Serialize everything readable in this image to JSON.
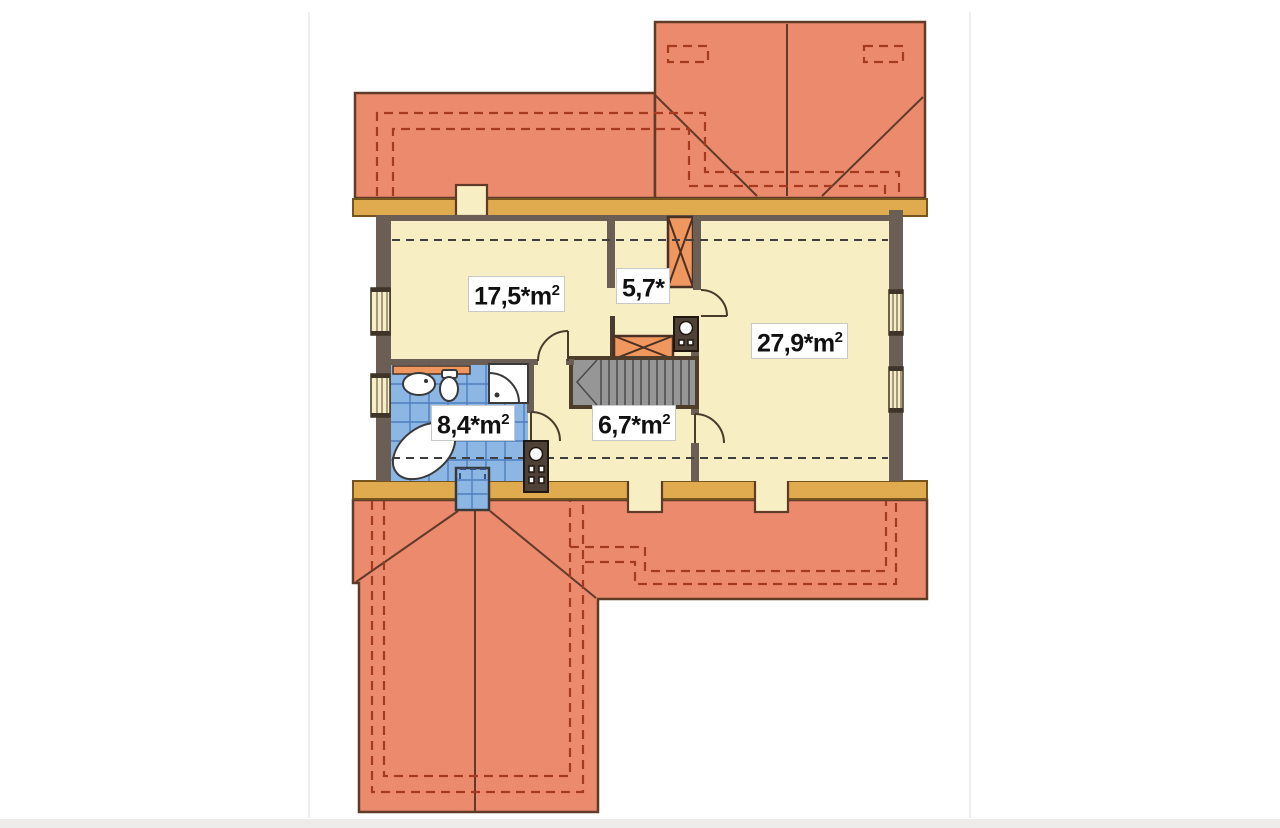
{
  "plan": {
    "colors": {
      "roof": "#EC8A6E",
      "roofLine": "#5F3B28",
      "roofDash": "#A63A1F",
      "band": "#E0AB4F",
      "bandLine": "#75541E",
      "floor": "#F7EEC3",
      "wall": "#6B5E55",
      "tile": "#8CB6E4",
      "tileLine": "#4F7FBD",
      "fixture": "#FFFFFF",
      "fixtureLine": "#3A3A3A",
      "orangeBox": "#F0975F",
      "stairFill": "#969696",
      "dashLine": "#3F3F3F",
      "labelBg": "#FFFFFF",
      "labelText": "#111111"
    },
    "rooms": [
      {
        "name": "room-left",
        "label": "17,5*",
        "unit": "m",
        "sup": "2"
      },
      {
        "name": "landing",
        "label": "5,7*",
        "unit": "",
        "sup": ""
      },
      {
        "name": "room-right",
        "label": "27,9*",
        "unit": "m",
        "sup": "2"
      },
      {
        "name": "bathroom",
        "label": "8,4*",
        "unit": "m",
        "sup": "2"
      },
      {
        "name": "hallway",
        "label": "6,7*",
        "unit": "m",
        "sup": "2"
      }
    ]
  }
}
